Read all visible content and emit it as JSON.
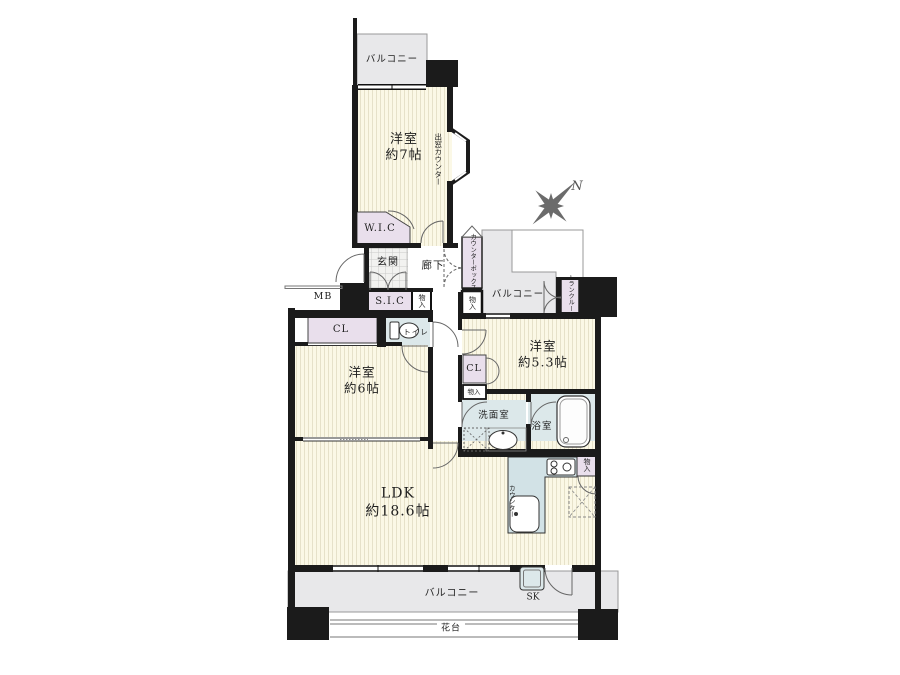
{
  "plan_type": "apartment-floor-plan",
  "labels": {
    "balcony_top": "バルコニー",
    "bedroom7_name": "洋室",
    "bedroom7_size": "約7帖",
    "bay_window_counter": "出窓カウンター",
    "wic": "W.I.C",
    "genkan": "玄関",
    "hallway": "廊下",
    "counter_box": "カウンターボックス",
    "storage_counterbox": "物入",
    "storage_hall": "物入",
    "mb": "MB",
    "sic": "S.I.C",
    "balcony_mid": "バルコニー",
    "trunk_room": "トランクルーム",
    "compass_n": "N",
    "cl_bedroom6": "CL",
    "toilet": "トイレ",
    "bedroom6_name": "洋室",
    "bedroom6_size": "約6帖",
    "bedroom53_name": "洋室",
    "bedroom53_size": "約5.3帖",
    "cl_bedroom53": "CL",
    "storage_bedroom53": "物入",
    "washroom": "洗面室",
    "bathroom": "浴室",
    "ldk_name": "LDK",
    "ldk_size": "約18.6帖",
    "kitchen_counter": "カウンター",
    "storage_kitchen": "物入",
    "balcony_bottom": "バルコニー",
    "sk": "SK",
    "flower_bed": "花台"
  },
  "colors": {
    "wall": "#1b1b1b",
    "room_fill": "#fbf8e6",
    "room_stripe": "#e6e1c9",
    "balcony_fill": "#e8e8ea",
    "closet_fill": "#e9dfec",
    "wet_area_fill": "#dce8ea",
    "kitchen_counter_fill": "#d2e2e6",
    "outline": "#555555",
    "compass": "#6b6b6b"
  }
}
